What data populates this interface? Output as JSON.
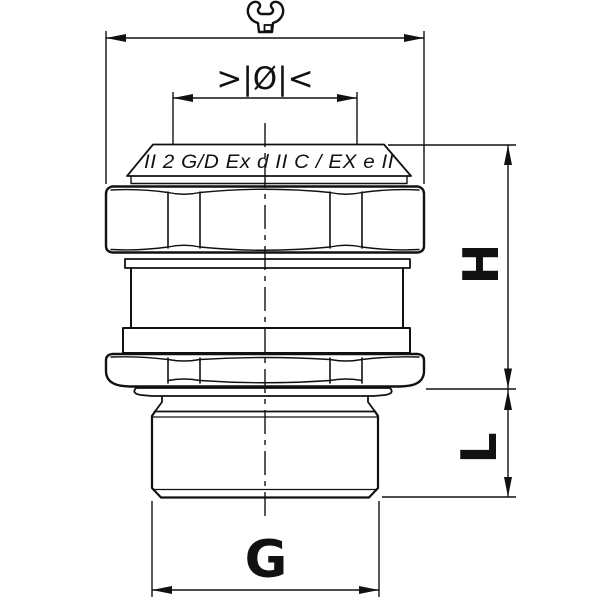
{
  "drawing": {
    "marking_text": "II 2 G/D Ex d II C / EX e II",
    "diameter_symbol": ">|Ø|<",
    "dimensions": {
      "height_label": "H",
      "thread_length_label": "L",
      "thread_size_label": "G"
    },
    "icons": {
      "wrench": "wrench-icon"
    },
    "colors": {
      "ink": "#111111",
      "background": "#ffffff"
    }
  }
}
